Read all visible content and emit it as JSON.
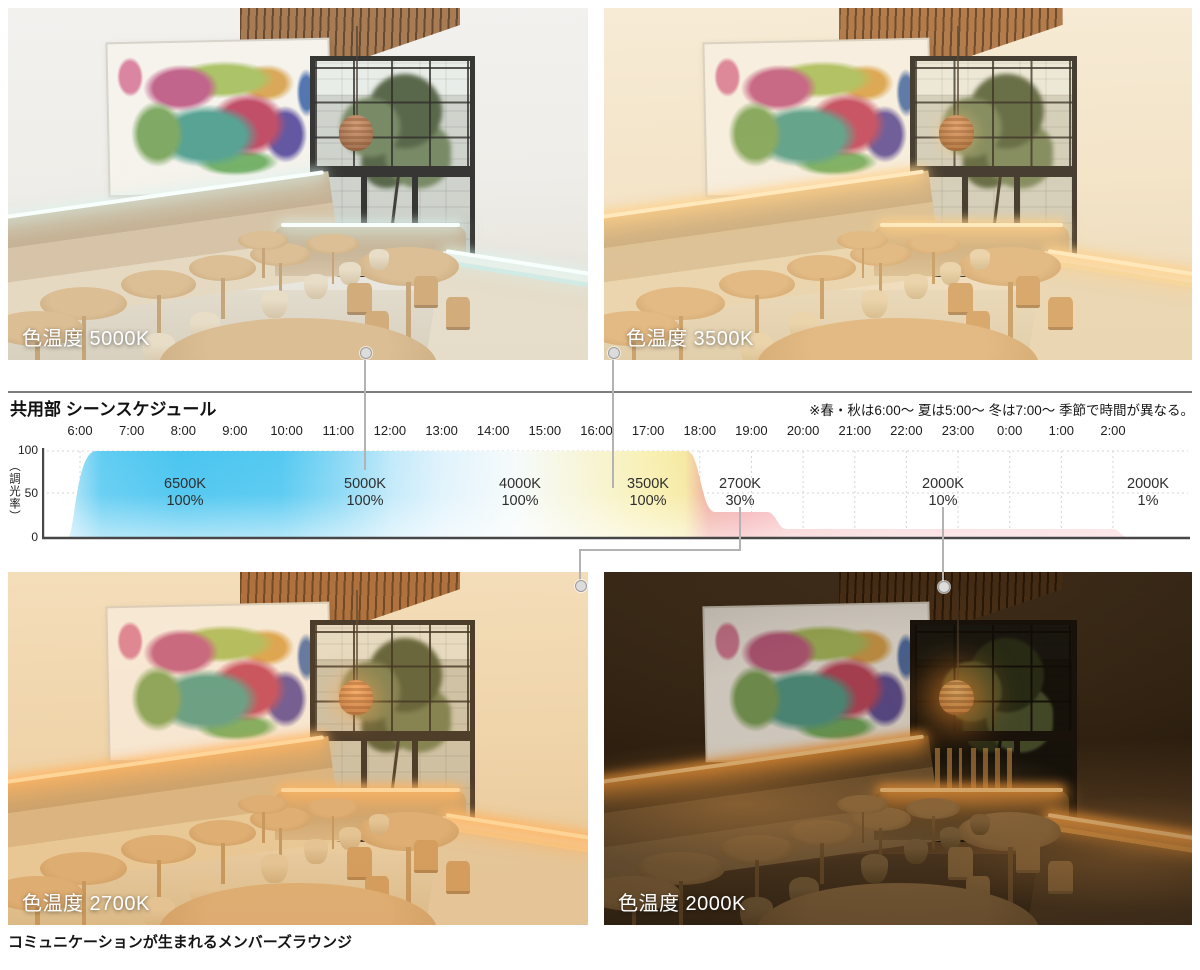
{
  "photos": [
    {
      "label": "色温度 5000K"
    },
    {
      "label": "色温度 3500K"
    },
    {
      "label": "色温度 2700K"
    },
    {
      "label": "色温度 2000K"
    }
  ],
  "chart": {
    "title": "共用部 シーンスケジュール",
    "note": "※春・秋は6:00～ 夏は5:00～ 冬は7:00～ 季節で時間が異なる。",
    "y_axis_label": "（調光率）",
    "y_ticks": [
      "100",
      "50",
      "0"
    ],
    "x_ticks": [
      "6:00",
      "7:00",
      "8:00",
      "9:00",
      "10:00",
      "11:00",
      "12:00",
      "13:00",
      "14:00",
      "15:00",
      "16:00",
      "17:00",
      "18:00",
      "19:00",
      "20:00",
      "21:00",
      "22:00",
      "23:00",
      "0:00",
      "1:00",
      "2:00"
    ],
    "segments": [
      {
        "kelvin": "6500K",
        "level": "100%"
      },
      {
        "kelvin": "5000K",
        "level": "100%"
      },
      {
        "kelvin": "4000K",
        "level": "100%"
      },
      {
        "kelvin": "3500K",
        "level": "100%"
      },
      {
        "kelvin": "2700K",
        "level": "30%"
      },
      {
        "kelvin": "2000K",
        "level": "10%"
      },
      {
        "kelvin": "2000K",
        "level": "1%"
      }
    ]
  },
  "caption": "コミュニケーションが生まれるメンバーズラウンジ",
  "colors": {
    "band_6500k": "#4ac5f0",
    "band_5000k": "#c3eafa",
    "band_4000k": "#f7fbfa",
    "band_3500k": "#f8f0b2",
    "band_2700k": "#f4a6aa",
    "band_2000k": "#f8cacd",
    "axis": "#474747",
    "connector": "#b3b3b3"
  },
  "chart_data": {
    "type": "area",
    "title": "共用部 シーンスケジュール",
    "ylabel": "調光率",
    "ylim": [
      0,
      100
    ],
    "grid": true,
    "x_ticks": [
      "6:00",
      "7:00",
      "8:00",
      "9:00",
      "10:00",
      "11:00",
      "12:00",
      "13:00",
      "14:00",
      "15:00",
      "16:00",
      "17:00",
      "18:00",
      "19:00",
      "20:00",
      "21:00",
      "22:00",
      "23:00",
      "0:00",
      "1:00",
      "2:00"
    ],
    "series": [
      {
        "name": "調光率スケジュール",
        "points": [
          [
            "6:00",
            0
          ],
          [
            "6:15",
            100
          ],
          [
            "17:50",
            100
          ],
          [
            "18:15",
            30
          ],
          [
            "19:20",
            30
          ],
          [
            "19:35",
            10
          ],
          [
            "2:00",
            10
          ],
          [
            "2:15",
            1
          ]
        ]
      }
    ],
    "color_bands": [
      {
        "label": "6500K",
        "dim_percent": 100,
        "color": "#4ac5f0"
      },
      {
        "label": "5000K",
        "dim_percent": 100,
        "color": "#c3eafa"
      },
      {
        "label": "4000K",
        "dim_percent": 100,
        "color": "#f7fbfa"
      },
      {
        "label": "3500K",
        "dim_percent": 100,
        "color": "#f8f0b2"
      },
      {
        "label": "2700K",
        "dim_percent": 30,
        "color": "#f4a6aa"
      },
      {
        "label": "2000K",
        "dim_percent": 10,
        "color": "#f8cacd"
      },
      {
        "label": "2000K",
        "dim_percent": 1,
        "color": "#f9d3d5"
      }
    ]
  }
}
